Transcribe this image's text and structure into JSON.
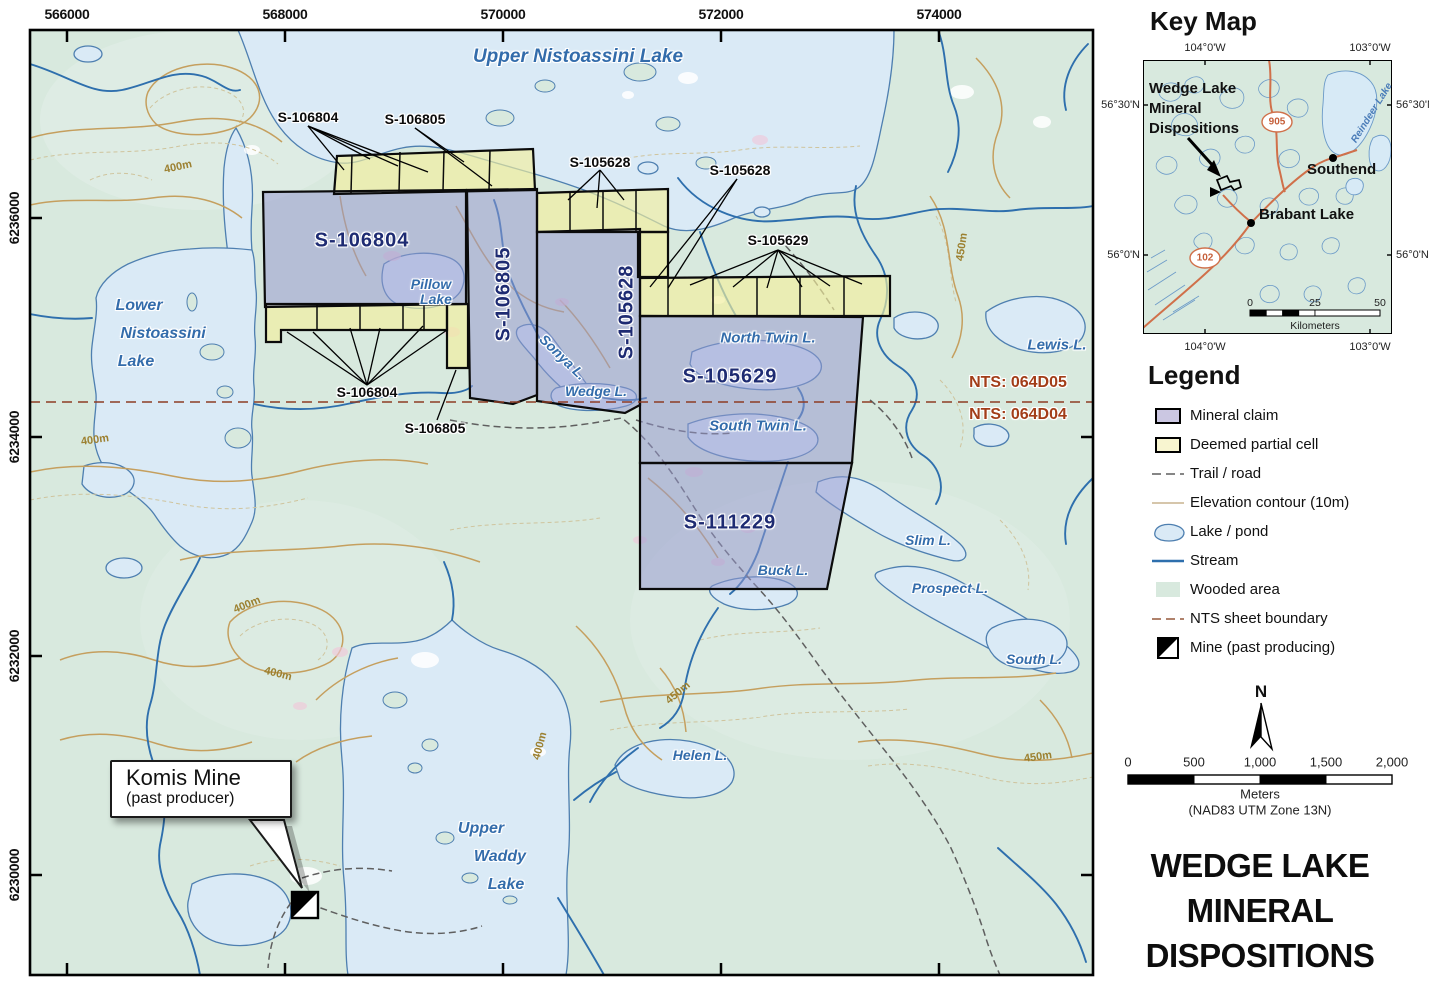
{
  "map": {
    "top_axis": [
      "566000",
      "568000",
      "570000",
      "572000",
      "574000"
    ],
    "left_axis": [
      "6236000",
      "6234000",
      "6232000",
      "6230000"
    ],
    "claims": {
      "c106804": "S-106804",
      "c106805": "S-106805",
      "c105628": "S-105628",
      "c105629": "S-105629",
      "c111229": "S-111229"
    },
    "leaders": {
      "top_106804": "S-106804",
      "top_106805": "S-106805",
      "ne_105628": "S-105628",
      "e_105628": "S-105628",
      "e_105629": "S-105629",
      "s_106804": "S-106804",
      "s_106805": "S-106805"
    },
    "lakes": {
      "upper_nistoassini": "Upper Nistoassini Lake",
      "lower_1": "Lower",
      "lower_2": "Nistoassini",
      "lower_3": "Lake",
      "pillow_1": "Pillow",
      "pillow_2": "Lake",
      "sonya": "Sonya L.",
      "wedge": "Wedge L.",
      "north_twin": "North Twin L.",
      "south_twin": "South Twin L.",
      "buck": "Buck L.",
      "lewis": "Lewis L.",
      "slim": "Slim L.",
      "prospect": "Prospect L.",
      "south": "South L.",
      "helen": "Helen L.",
      "waddy_1": "Upper",
      "waddy_2": "Waddy",
      "waddy_3": "Lake"
    },
    "nts_top": "NTS: 064D05",
    "nts_bottom": "NTS: 064D04",
    "contours": [
      "400m",
      "400m",
      "400m",
      "400m",
      "400m",
      "450m",
      "450m",
      "450m"
    ],
    "callout_title": "Komis Mine",
    "callout_sub": "(past producer)"
  },
  "keymap": {
    "title": "Key Map",
    "lon_left": "104°0'W",
    "lon_right": "103°0'W",
    "lat_upper": "56°30'N",
    "lat_lower": "56°0'N",
    "annotation_1": "Wedge Lake",
    "annotation_2": "Mineral",
    "annotation_3": "Dispositions",
    "town_southend": "Southend",
    "town_brabant": "Brabant Lake",
    "reindeer": "Reindeer Lake",
    "shield_905": "905",
    "shield_102": "102",
    "scale_0": "0",
    "scale_25": "25",
    "scale_50": "50",
    "scale_unit": "Kilometers"
  },
  "legend": {
    "title": "Legend",
    "items": [
      "Mineral claim",
      "Deemed partial cell",
      "Trail / road",
      "Elevation contour (10m)",
      "Lake / pond",
      "Stream",
      "Wooded area",
      "NTS sheet boundary",
      "Mine (past producing)"
    ]
  },
  "compass": "N",
  "scalebar": {
    "t0": "0",
    "t500": "500",
    "t1000": "1,000",
    "t1500": "1,500",
    "t2000": "2,000",
    "unit": "Meters",
    "datum": "(NAD83 UTM Zone 13N)"
  },
  "title": {
    "line1": "WEDGE LAKE",
    "line2": "MINERAL",
    "line3": "DISPOSITIONS"
  },
  "colors": {
    "mineral_claim": "#cbc7e2",
    "partial_cell": "#f8f5d0",
    "wooded": "#d8e9de",
    "lake_fill": "#daeaf6",
    "lake_stroke": "#4e7fb0",
    "stream": "#2e6fad",
    "contour": "#c59f5e",
    "trail": "#5f5f5f",
    "nts_line": "#8d3c24",
    "road": "#d0704a",
    "claim_text": "#1e2b72",
    "lake_text": "#336cab",
    "nts_text": "#a23d18"
  }
}
